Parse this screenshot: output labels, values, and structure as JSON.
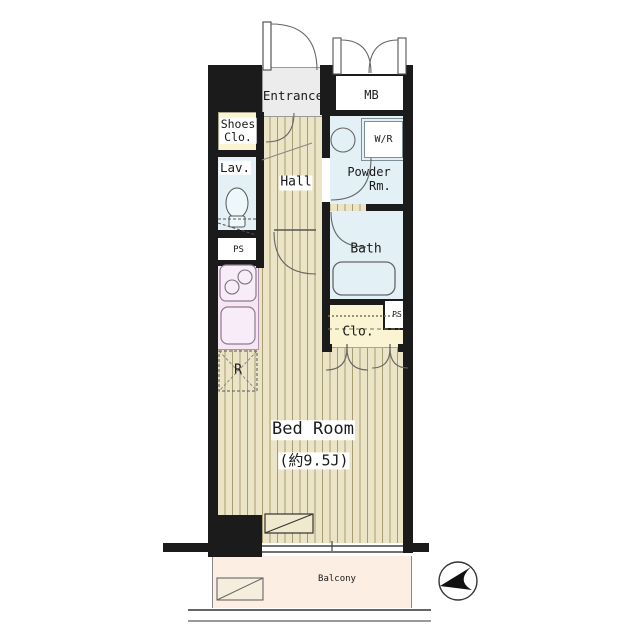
{
  "plan": {
    "title": "studio apartment floor plan",
    "rooms": {
      "entrance": "Entrance",
      "meter_box": "MB",
      "shoes_closet": "Shoes\nClo.",
      "lavatory": "Lav.",
      "hall": "Hall",
      "powder_room": "Powder\n   Rm.",
      "washer": "W/R",
      "bath": "Bath",
      "pipe_space_left": "PS",
      "pipe_space_right": "PS",
      "closet": "Clo.",
      "refrigerator": "R",
      "bedroom_name": "Bed Room",
      "bedroom_size": "(約9.5J)",
      "balcony": "Balcony"
    },
    "colors": {
      "wall": "#1b1b1b",
      "floor": "#ece4c6",
      "stripe": "#a89c72",
      "water": "#e3f1f6",
      "cream": "#faf4d3",
      "kitchen": "#f7e5f6",
      "entrance": "#ececec",
      "balcony": "#fceee2",
      "line": "#444444"
    }
  }
}
